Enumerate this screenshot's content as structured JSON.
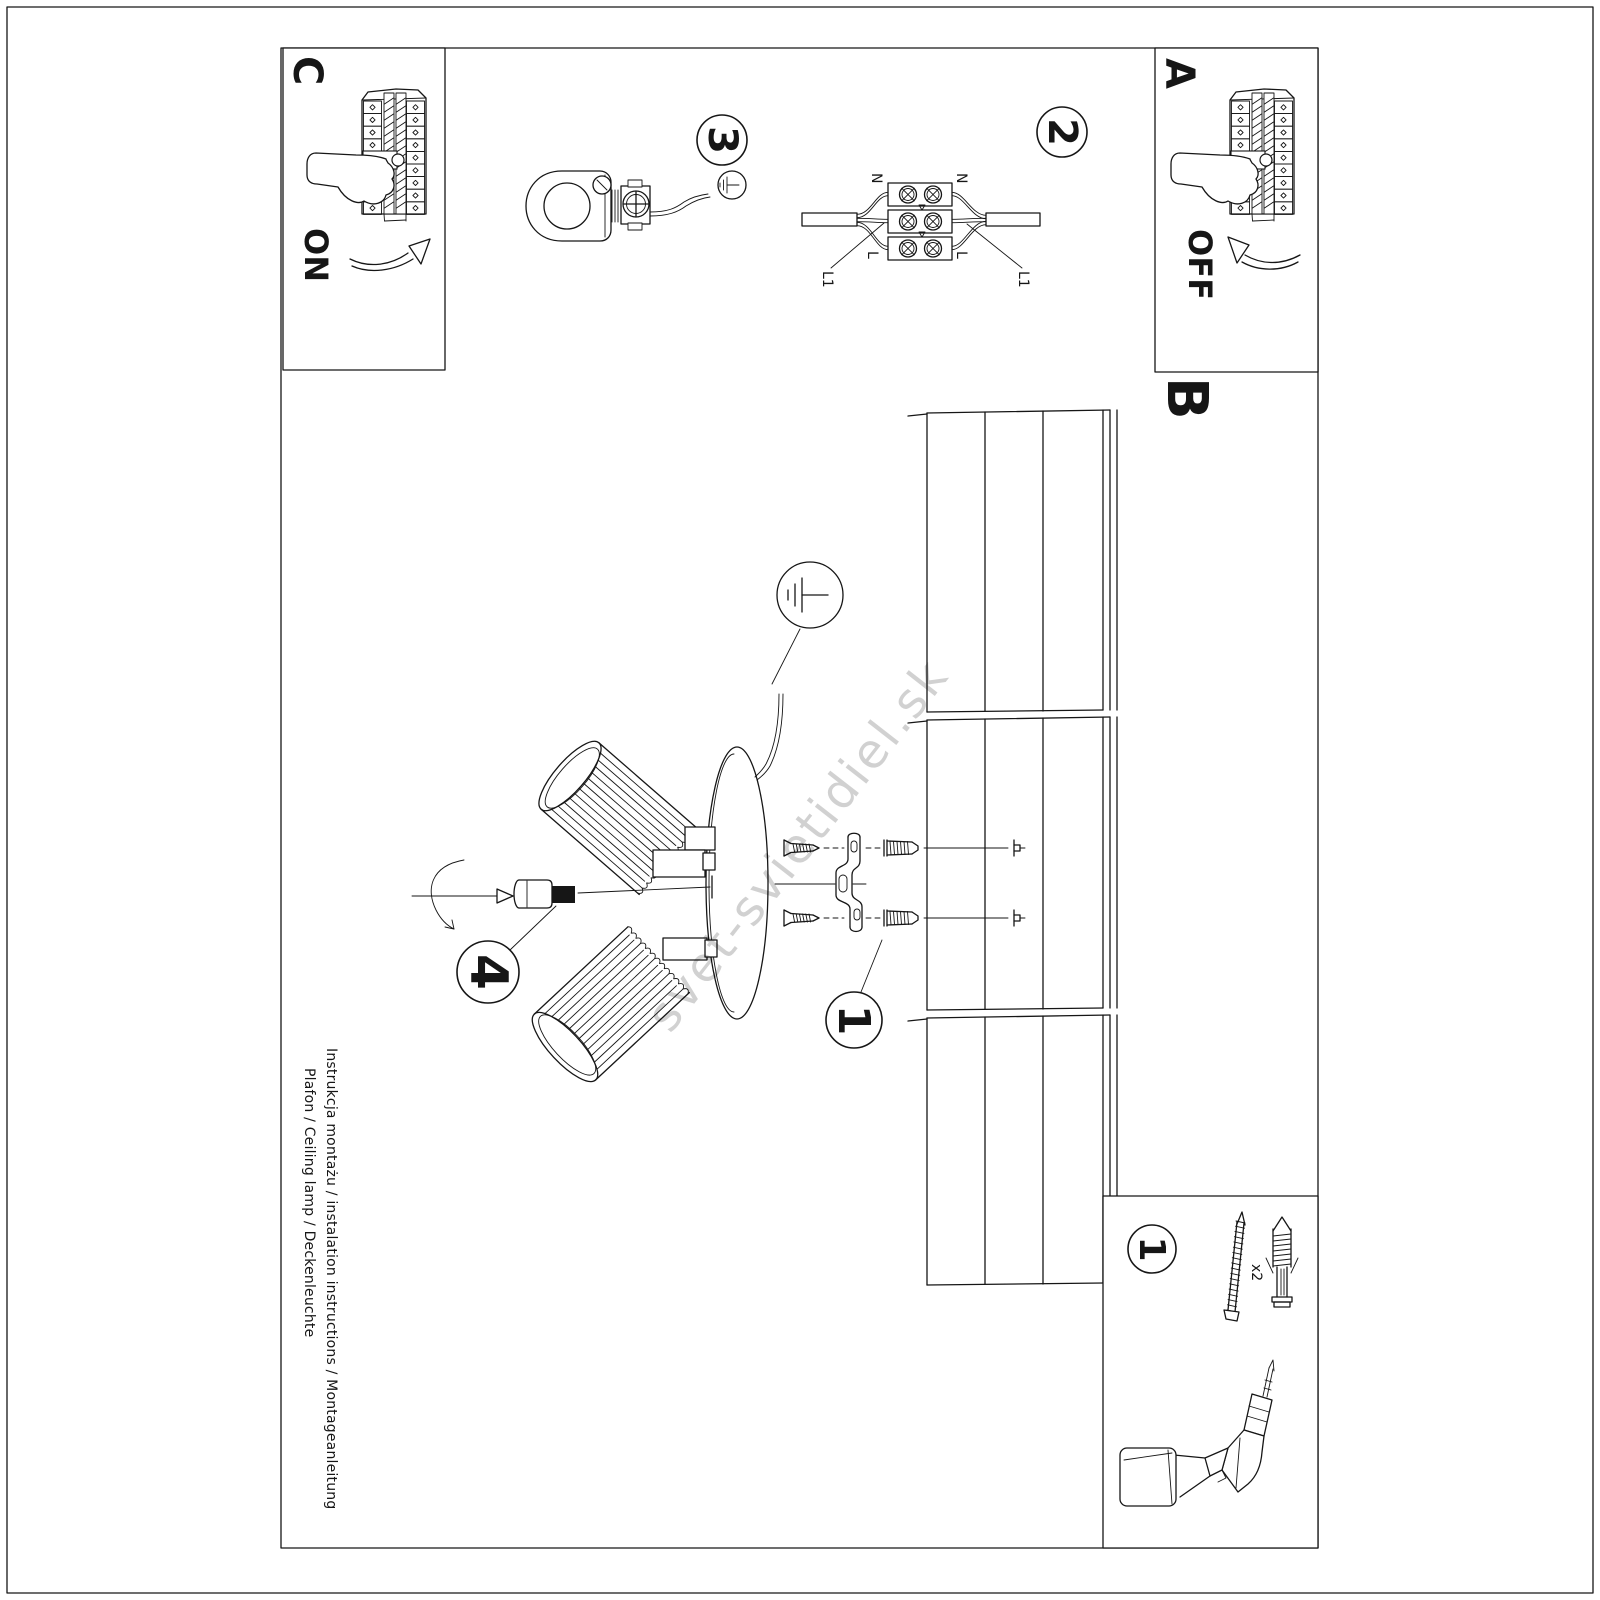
{
  "document": {
    "footer": {
      "line1": "Instrukcja montażu / instalation instructions / Montageanleitung",
      "line2": "Plafon / Ceiling lamp / Deckenleuchte"
    },
    "watermark": "svet-svietidiel.sk"
  },
  "sections": {
    "a": {
      "label": "A",
      "caption": "OFF"
    },
    "b": {
      "label": "B"
    },
    "c": {
      "label": "C",
      "caption": "ON"
    }
  },
  "steps": {
    "one": "1",
    "two": "2",
    "three": "3",
    "four": "4"
  },
  "tools": {
    "step_label": "1",
    "quantity": "x2"
  },
  "wiring_labels": {
    "n": "N",
    "l": "L",
    "l1": "L1"
  },
  "colors": {
    "ink": "#161616",
    "paper": "#ffffff",
    "watermark_gray": "#cccccc"
  },
  "icons": [
    "fuse-box-icon",
    "pointing-hand-icon",
    "curved-arrow-icon",
    "terminal-block-icon",
    "cable-clamp-icon",
    "earth-ground-icon",
    "ceiling-panels-icon",
    "ceiling-lamp-exploded-icon",
    "mounting-bracket-icon",
    "screw-icon",
    "wall-plug-icon",
    "drill-icon",
    "set-screw-icon",
    "rotation-arrow-icon"
  ]
}
